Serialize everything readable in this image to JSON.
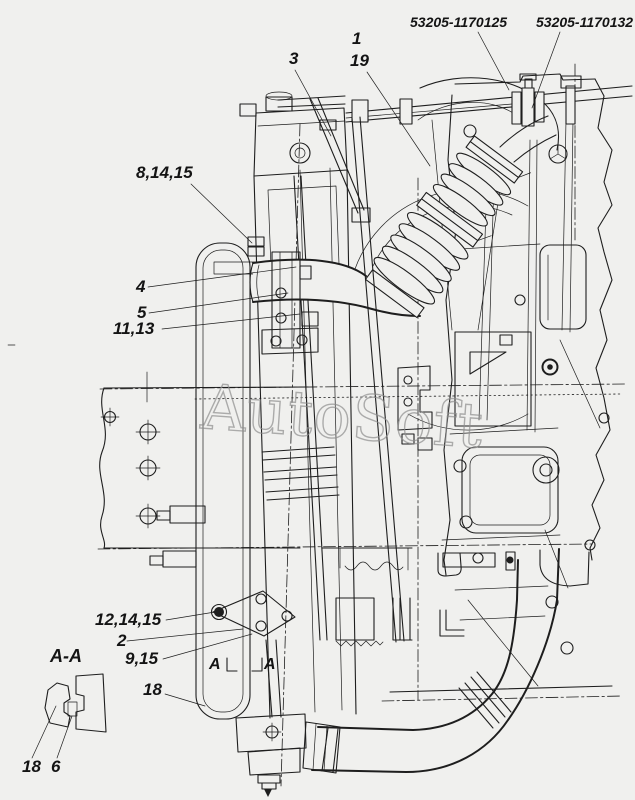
{
  "colors": {
    "background": "#f0f0ee",
    "line": "#1e1e1e",
    "watermark": "#8e8e8e",
    "label": "#141414"
  },
  "watermark": {
    "text": "AutoSoft"
  },
  "part_numbers": {
    "left": "53205-1170125",
    "right": "53205-1170132"
  },
  "callouts": {
    "hose": "1",
    "clamp": "19",
    "bracket_top": "3",
    "group_8_14_15": "8,14,15",
    "item_4": "4",
    "item_5": "5",
    "group_11_13": "11,13",
    "group_12_14_15": "12,14,15",
    "item_2": "2",
    "group_9_15": "9,15",
    "item_18": "18"
  },
  "section_view": {
    "title": "A-A",
    "item_18": "18",
    "item_6": "6"
  },
  "section_markers": {
    "left": "A",
    "right": "A"
  }
}
